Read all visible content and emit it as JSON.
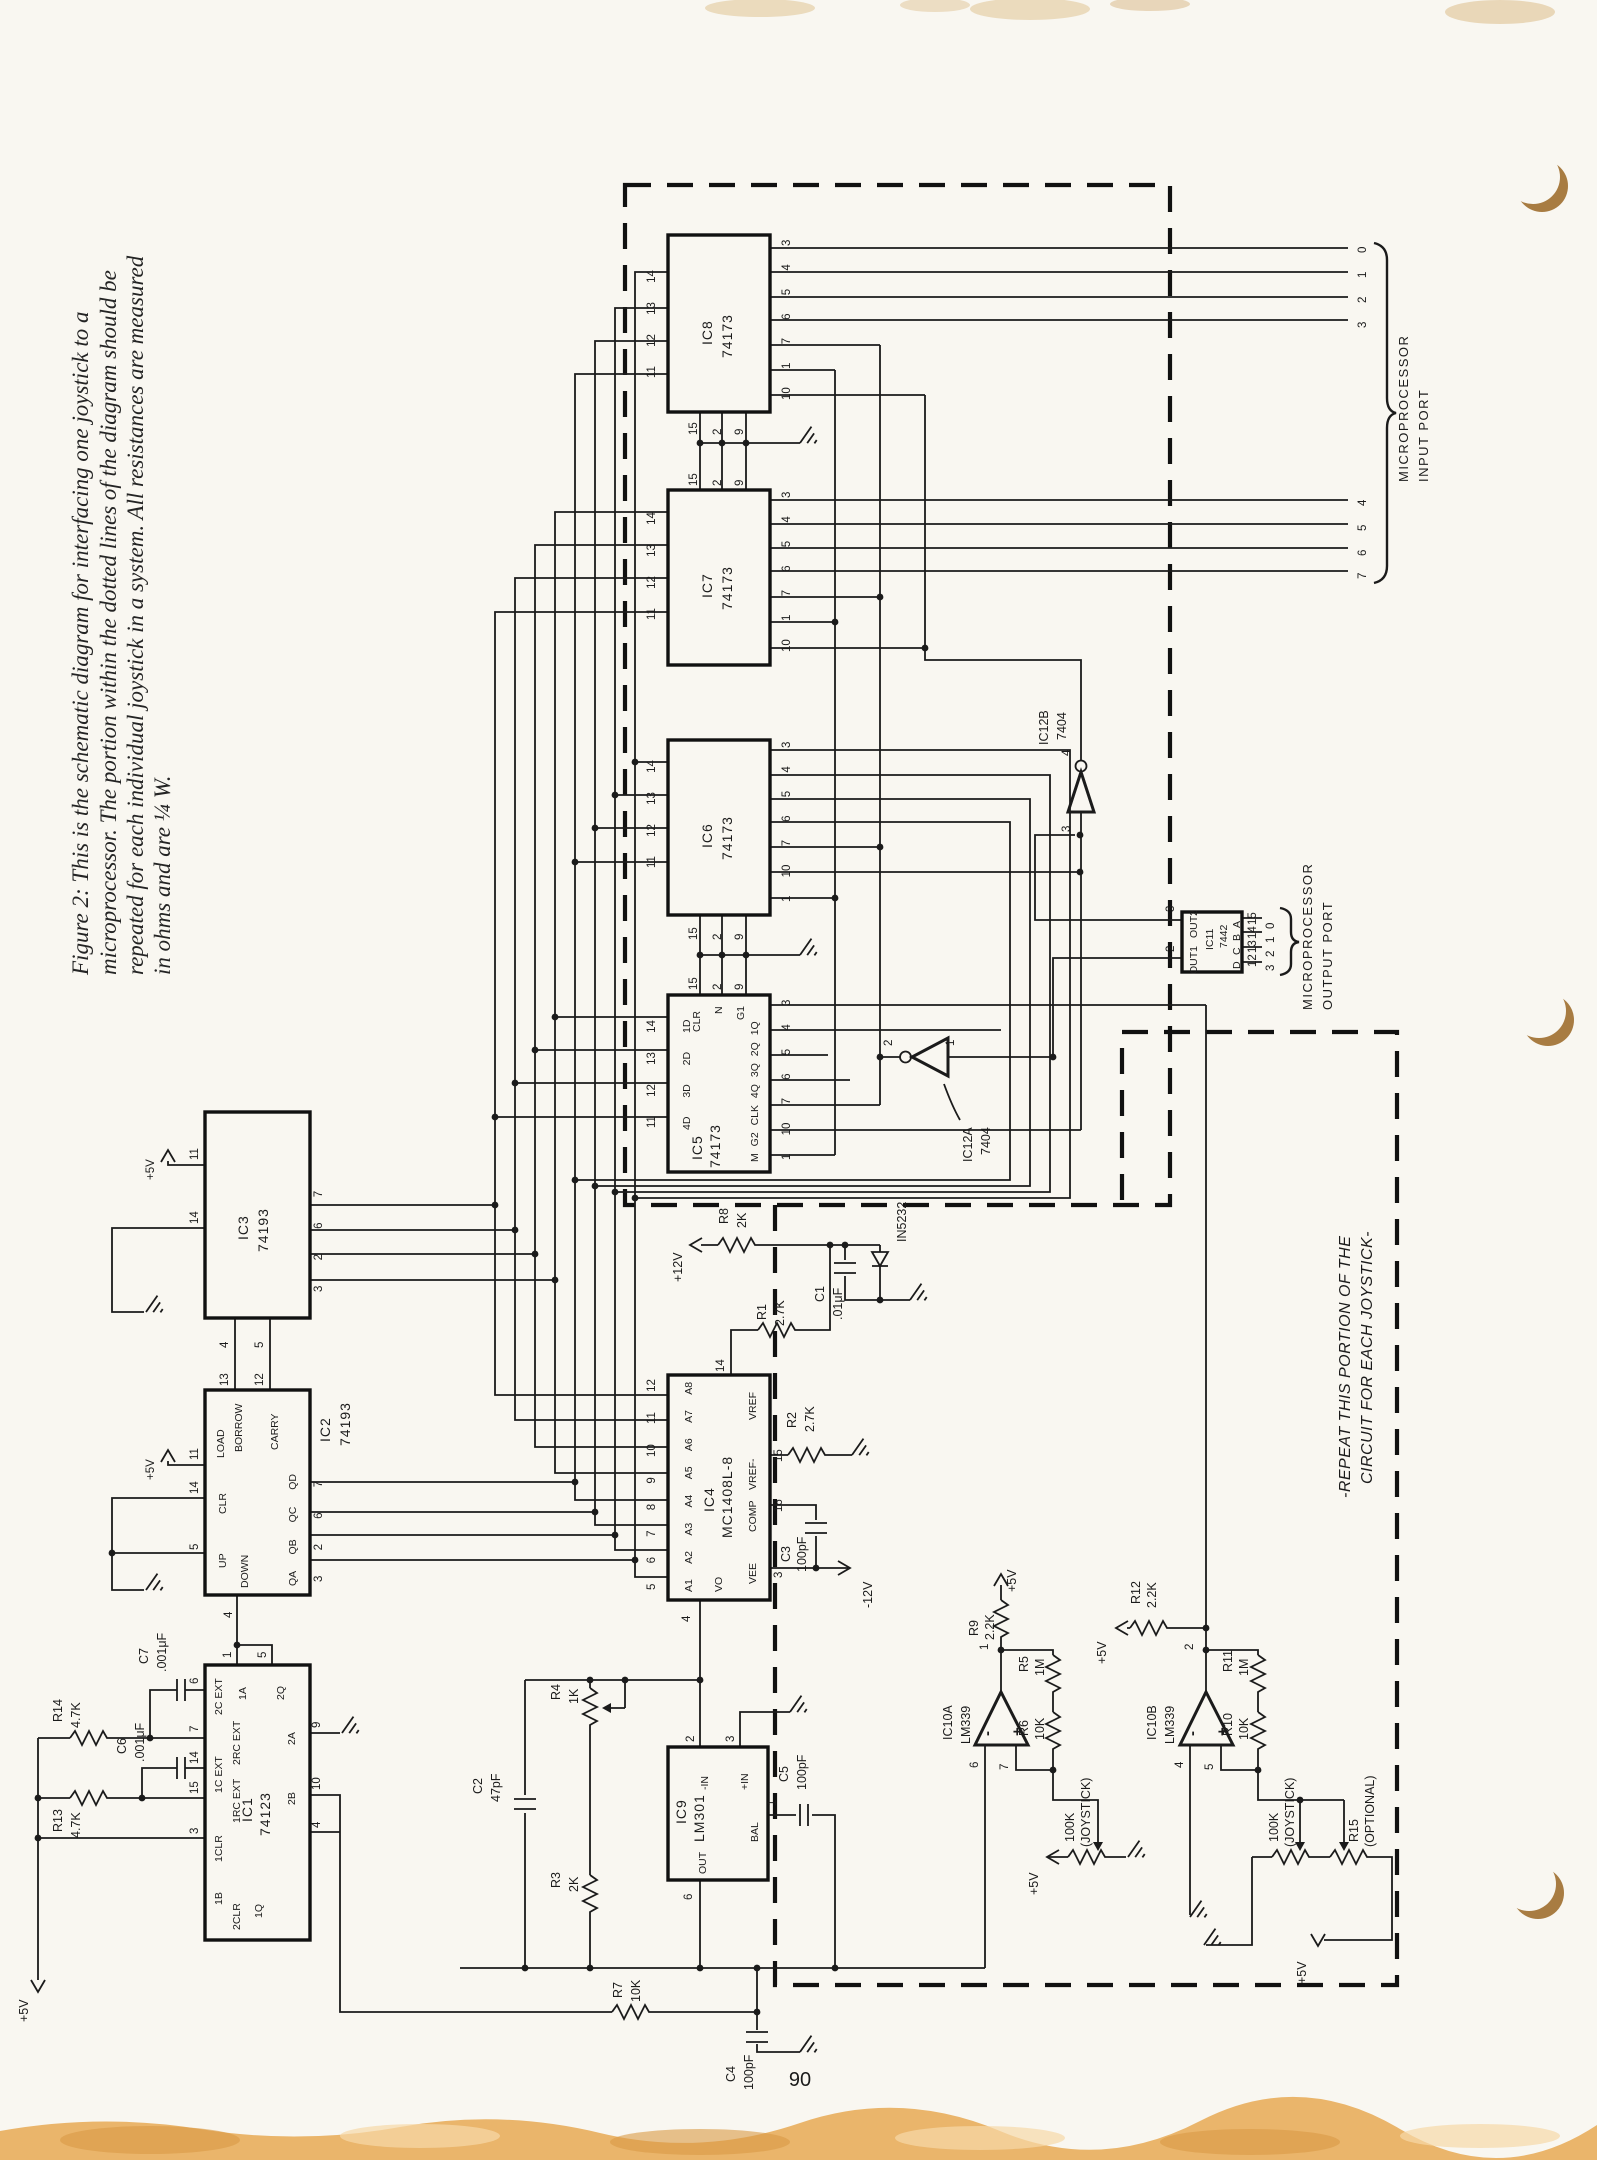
{
  "caption": {
    "line1": "Figure 2: This is the schematic diagram for interfacing one joystick to a",
    "line2": "microprocessor. The portion within the dotted lines of the diagram should be",
    "line3": "repeated for each individual joystick in a system. All resistances are measured",
    "line4": "in ohms and are ¼ W."
  },
  "page_number": "90",
  "note": [
    "-REPEAT THIS PORTION OF THE",
    "CIRCUIT FOR EACH JOYSTICK-"
  ],
  "ports": {
    "input": {
      "bits": [
        "0",
        "1",
        "2",
        "3",
        "4",
        "5",
        "6",
        "7"
      ],
      "label": [
        "MICROPROCESSOR",
        "INPUT PORT"
      ]
    },
    "output": {
      "bits": [
        "0",
        "1",
        "2",
        "3"
      ],
      "label": [
        "MICROPROCESSOR",
        "OUTPUT PORT"
      ]
    }
  },
  "power": {
    "p5": "+5V",
    "p12": "+12V",
    "m12": "-12V"
  },
  "ics": {
    "ic8": {
      "name": "IC8",
      "part": "74173",
      "pins_left": [
        "14",
        "13",
        "12",
        "11"
      ],
      "pins_right": [
        "3",
        "4",
        "5",
        "6",
        "7",
        "1",
        "10"
      ],
      "pins_bottom": [
        "15",
        "2",
        "9"
      ]
    },
    "ic7": {
      "name": "IC7",
      "part": "74173",
      "pins_top": [
        "15",
        "2",
        "9"
      ],
      "pins_left": [
        "14",
        "13",
        "12",
        "11"
      ],
      "pins_right": [
        "3",
        "4",
        "5",
        "6",
        "7",
        "1",
        "10"
      ]
    },
    "ic6": {
      "name": "IC6",
      "part": "74173",
      "pins_left": [
        "14",
        "13",
        "12",
        "11"
      ],
      "pins_right": [
        "3",
        "4",
        "5",
        "6",
        "7",
        "10",
        "1"
      ],
      "pins_bottom": [
        "15",
        "2",
        "9"
      ]
    },
    "ic5": {
      "name": "IC5",
      "part": "74173",
      "pins_top": [
        "15",
        "2",
        "9"
      ],
      "labels_top": [
        "CLR",
        "N",
        "G1"
      ],
      "pins_left": [
        "14",
        "13",
        "12",
        "11"
      ],
      "labels_left": [
        "1D",
        "2D",
        "3D",
        "4D"
      ],
      "pins_right": [
        "3",
        "4",
        "5",
        "6",
        "7",
        "10",
        "1"
      ],
      "labels_right": [
        "1Q",
        "2Q",
        "3Q",
        "4Q",
        "CLK",
        "G2",
        "M"
      ]
    },
    "ic3": {
      "name": "IC3",
      "part": "74193",
      "pin_vcc": "11",
      "pin_clr": "14",
      "pins_right": [
        "7",
        "6",
        "2",
        "3"
      ],
      "pins_bottom": [
        "4",
        "5"
      ]
    },
    "ic2": {
      "name": "IC2",
      "part": "74193",
      "pin_vcc": "11",
      "labels": {
        "load": "LOAD",
        "borrow": "BORROW",
        "carry": "CARRY",
        "clr": "CLR",
        "up": "UP",
        "down": "DOWN"
      },
      "pins_top": [
        "13",
        "12"
      ],
      "pin_clr": "14",
      "pin_up": "5",
      "pin_down": "4",
      "pins_right": [
        "7",
        "6",
        "2",
        "3"
      ],
      "labels_right": [
        "QD",
        "QC",
        "QB",
        "QA"
      ]
    },
    "ic1": {
      "name": "IC1",
      "part": "74123",
      "pins_top": [
        "1",
        "5"
      ],
      "labels_top": [
        "1A",
        "2Q"
      ],
      "pins_left": [
        "6",
        "7",
        "14",
        "15",
        "3"
      ],
      "labels_left": [
        "2C EXT",
        "2RC EXT",
        "1C EXT",
        "1RC EXT",
        "1CLR"
      ],
      "labels_misc": [
        "1B",
        "2CLR",
        "1Q",
        "2B",
        "2A"
      ],
      "pins_right": [
        "9",
        "10",
        "4"
      ]
    },
    "ic4": {
      "name": "IC4",
      "part": "MC1408L-8",
      "pins_left": [
        "12",
        "11",
        "10",
        "9",
        "8",
        "7",
        "6",
        "5"
      ],
      "labels_left": [
        "A8",
        "A7",
        "A6",
        "A5",
        "A4",
        "A3",
        "A2",
        "A1"
      ],
      "pin_vref": "14",
      "pin_out": "4",
      "label_out": "VO",
      "pins_right": [
        "15",
        "16",
        "3"
      ],
      "labels_right": [
        "VREF",
        "VREF-",
        "COMP",
        "VEE"
      ]
    },
    "ic9": {
      "name": "IC9",
      "part": "LM301",
      "pins_top": [
        "2",
        "3"
      ],
      "labels_top": [
        "-IN",
        "+IN"
      ],
      "pin_bal": "1",
      "label_bal": "BAL",
      "pin_out": "6",
      "label_out": "OUT"
    },
    "ic11": {
      "name": "IC11",
      "part": "7442",
      "pins_left": [
        "3",
        "2"
      ],
      "labels_left": [
        "OUT2",
        "OUT1"
      ],
      "pins_right": [
        "15",
        "14",
        "13",
        "12"
      ],
      "labels_right": [
        "A",
        "B",
        "C",
        "D"
      ],
      "bits": [
        "0",
        "1",
        "2",
        "3"
      ]
    },
    "ic12a": {
      "name": "IC12A",
      "part": "7404",
      "pin_in": "1",
      "pin_out": "2"
    },
    "ic12b": {
      "name": "IC12B",
      "part": "7404",
      "pin_in": "3",
      "pin_out": "4"
    },
    "ic10a": {
      "name": "IC10A",
      "part": "LM339",
      "pin_out": "1",
      "pin_minus": "6",
      "pin_plus": "7",
      "minus": "-",
      "plus": "+"
    },
    "ic10b": {
      "name": "IC10B",
      "part": "LM339",
      "pin_out": "2",
      "pin_minus": "4",
      "pin_plus": "5",
      "minus": "-",
      "plus": "+"
    }
  },
  "parts": {
    "r1": [
      "R1",
      "2.7K"
    ],
    "r2": [
      "R2",
      "2.7K"
    ],
    "r3": [
      "R3",
      "2K"
    ],
    "r4": [
      "R4",
      "1K"
    ],
    "r5": [
      "R5",
      "1M"
    ],
    "r6": [
      "R6",
      "10K"
    ],
    "r7": [
      "R7",
      "10K"
    ],
    "r8": [
      "R8",
      "2K"
    ],
    "r9": [
      "R9",
      "2.2K"
    ],
    "r10": [
      "R10",
      "10K"
    ],
    "r11": [
      "R11",
      "1M"
    ],
    "r12": [
      "R12",
      "2.2K"
    ],
    "r13": [
      "R13",
      "4.7K"
    ],
    "r14": [
      "R14",
      "4.7K"
    ],
    "r15": [
      "R15",
      "(OPTIONAL)"
    ],
    "c1": [
      "C1",
      ".01μF"
    ],
    "c2": [
      "C2",
      "47pF"
    ],
    "c3": [
      "C3",
      "100pF"
    ],
    "c4": [
      "C4",
      "100pF"
    ],
    "c5": [
      "C5",
      "100pF"
    ],
    "c6": [
      "C6",
      ".001μF"
    ],
    "c7": [
      "C7",
      ".001μF"
    ],
    "pot1": [
      "100K",
      "(JOYSTICK)"
    ],
    "pot2": [
      "100K",
      "(JOYSTICK)"
    ],
    "d1": "IN5232"
  }
}
